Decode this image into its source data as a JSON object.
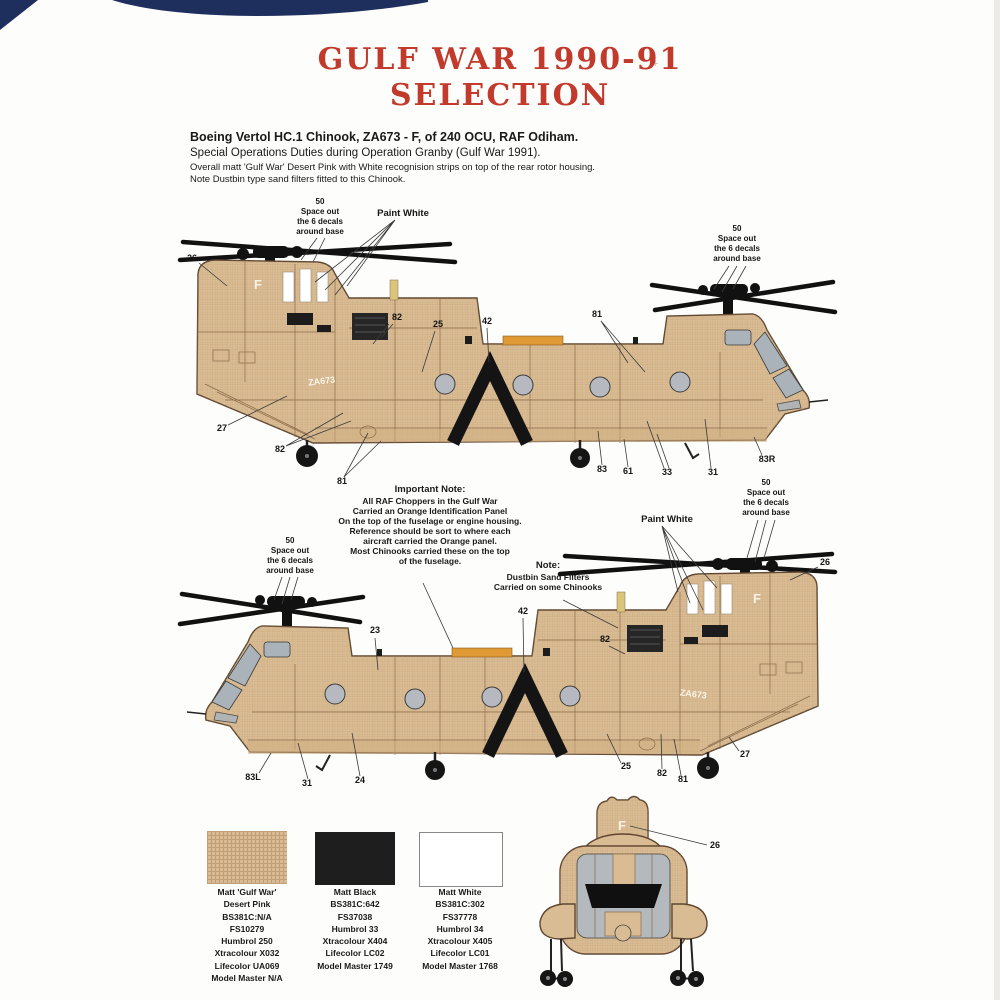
{
  "doc": {
    "title_line1": "GULF WAR 1990-91",
    "title_line2": "SELECTION",
    "intro": {
      "line1": "Boeing Vertol HC.1 Chinook, ZA673 - F, of 240 OCU, RAF Odiham.",
      "line2": "Special Operations Duties during Operation Granby (Gulf War 1991).",
      "line3": "Overall matt 'Gulf War' Desert Pink with White recognision strips on top of the rear rotor housing.",
      "line4": "Note Dustbin type sand filters fitted to this Chinook."
    }
  },
  "aircraft": {
    "serial": "ZA673",
    "code_letter": "F"
  },
  "decal_note": {
    "num": "50",
    "l1": "Space out",
    "l2": "the 6 decals",
    "l3": "around base"
  },
  "paint_white": "Paint White",
  "important_note": {
    "heading": "Important Note:",
    "lines": [
      "All RAF Choppers in the Gulf War",
      "Carried an Orange Identification Panel",
      "On the top of the fuselage or engine housing.",
      "Reference should be sort to where each",
      "aircraft carried the Orange panel.",
      "Most Chinooks carried these on the top",
      "of the fuselage."
    ]
  },
  "dustbin_note": {
    "heading": "Note:",
    "lines": [
      "Dustbin Sand Filters",
      "Carried on some Chinooks"
    ]
  },
  "top_callouts": {
    "n26": "26",
    "n82a": "82",
    "n25": "25",
    "n42": "42",
    "n81a": "81",
    "n27": "27",
    "n82b": "82",
    "n81b": "81",
    "n83": "83",
    "n61": "61",
    "n33": "33",
    "n31": "31",
    "n83r": "83R"
  },
  "bottom_callouts": {
    "n26": "26",
    "n23": "23",
    "n42": "42",
    "n82a": "82",
    "n83l": "83L",
    "n31": "31",
    "n24": "24",
    "n25": "25",
    "n82b": "82",
    "n81": "81",
    "n27": "27"
  },
  "rear_callouts": {
    "n26": "26"
  },
  "paints": [
    {
      "lines": [
        "Matt 'Gulf War'",
        "Desert Pink",
        "BS381C:N/A",
        "FS10279",
        "Humbrol 250",
        "Xtracolour X032",
        "Lifecolor UA069",
        "Model Master N/A"
      ]
    },
    {
      "lines": [
        "Matt Black",
        "BS381C:642",
        "FS37038",
        "Humbrol 33",
        "Xtracolour X404",
        "Lifecolor LC02",
        "Model Master 1749"
      ]
    },
    {
      "lines": [
        "Matt White",
        "BS381C:302",
        "FS37778",
        "Humbrol 34",
        "Xtracolour X405",
        "Lifecolor LC01",
        "Model Master 1768"
      ]
    }
  ],
  "colors": {
    "title_red": "#c13a2b",
    "navy": "#1e2f5d",
    "desert_pink": "#d8bb92",
    "matt_black": "#1e1e1e",
    "matt_white": "#ffffff",
    "orange_panel": "#e09a35"
  },
  "misc": {
    "plus_mark": "+"
  }
}
